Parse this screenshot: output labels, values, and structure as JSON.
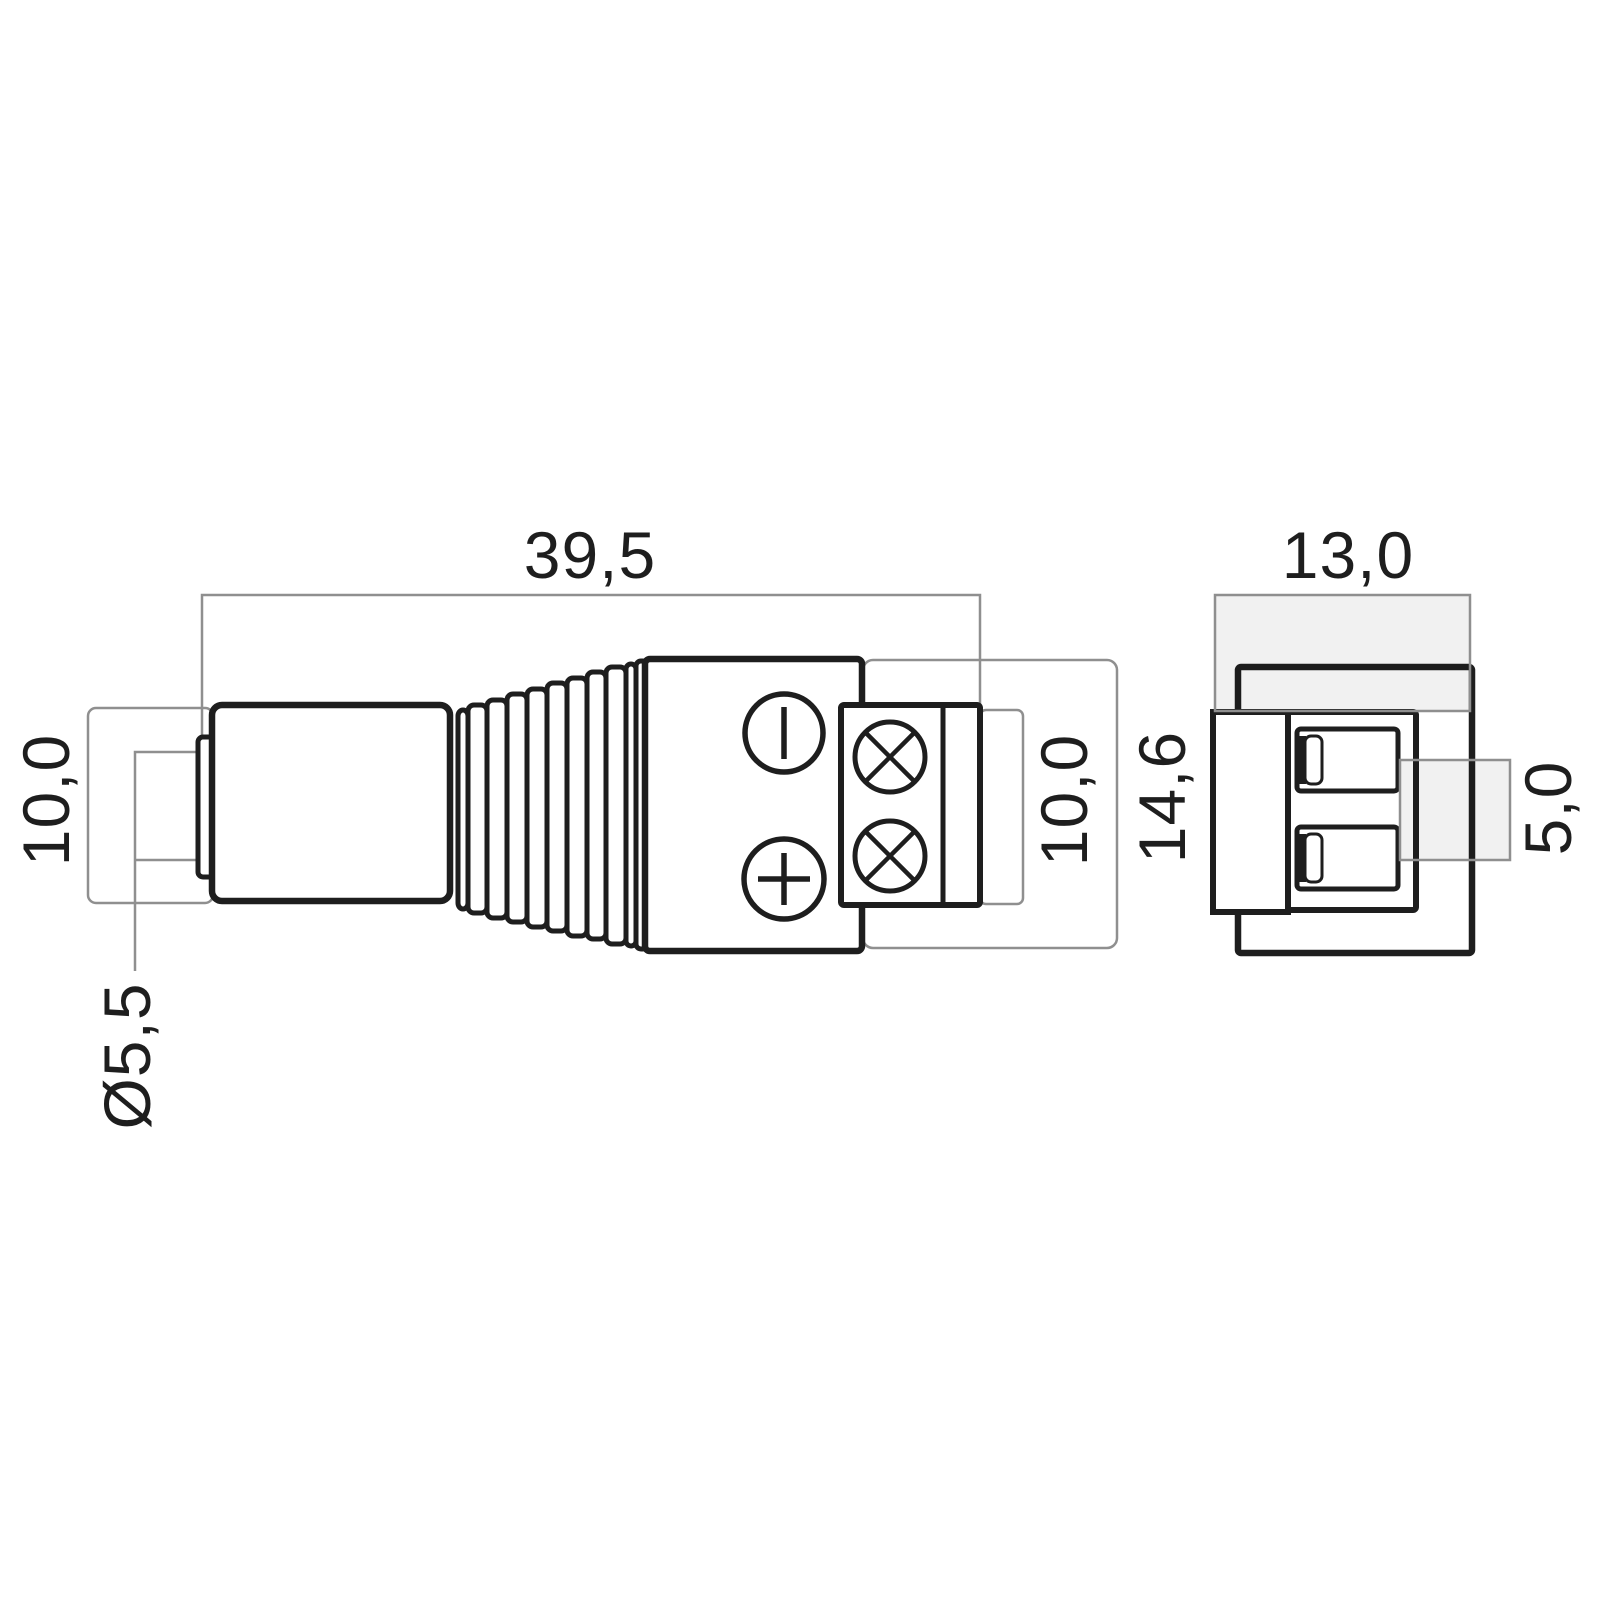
{
  "drawing": {
    "labels": {
      "length": "39,5",
      "end_width": "13,0",
      "barrel_diameter": "10,0",
      "tip_diameter": "Ø5,5",
      "terminal_height": "10,0",
      "housing_height": "14,6",
      "pin_pitch": "5,0"
    },
    "colors": {
      "outline": "#1e1e1e",
      "dimension_line": "#8f8f8f",
      "dimension_fill": "#ededed",
      "background": "#ffffff"
    }
  }
}
